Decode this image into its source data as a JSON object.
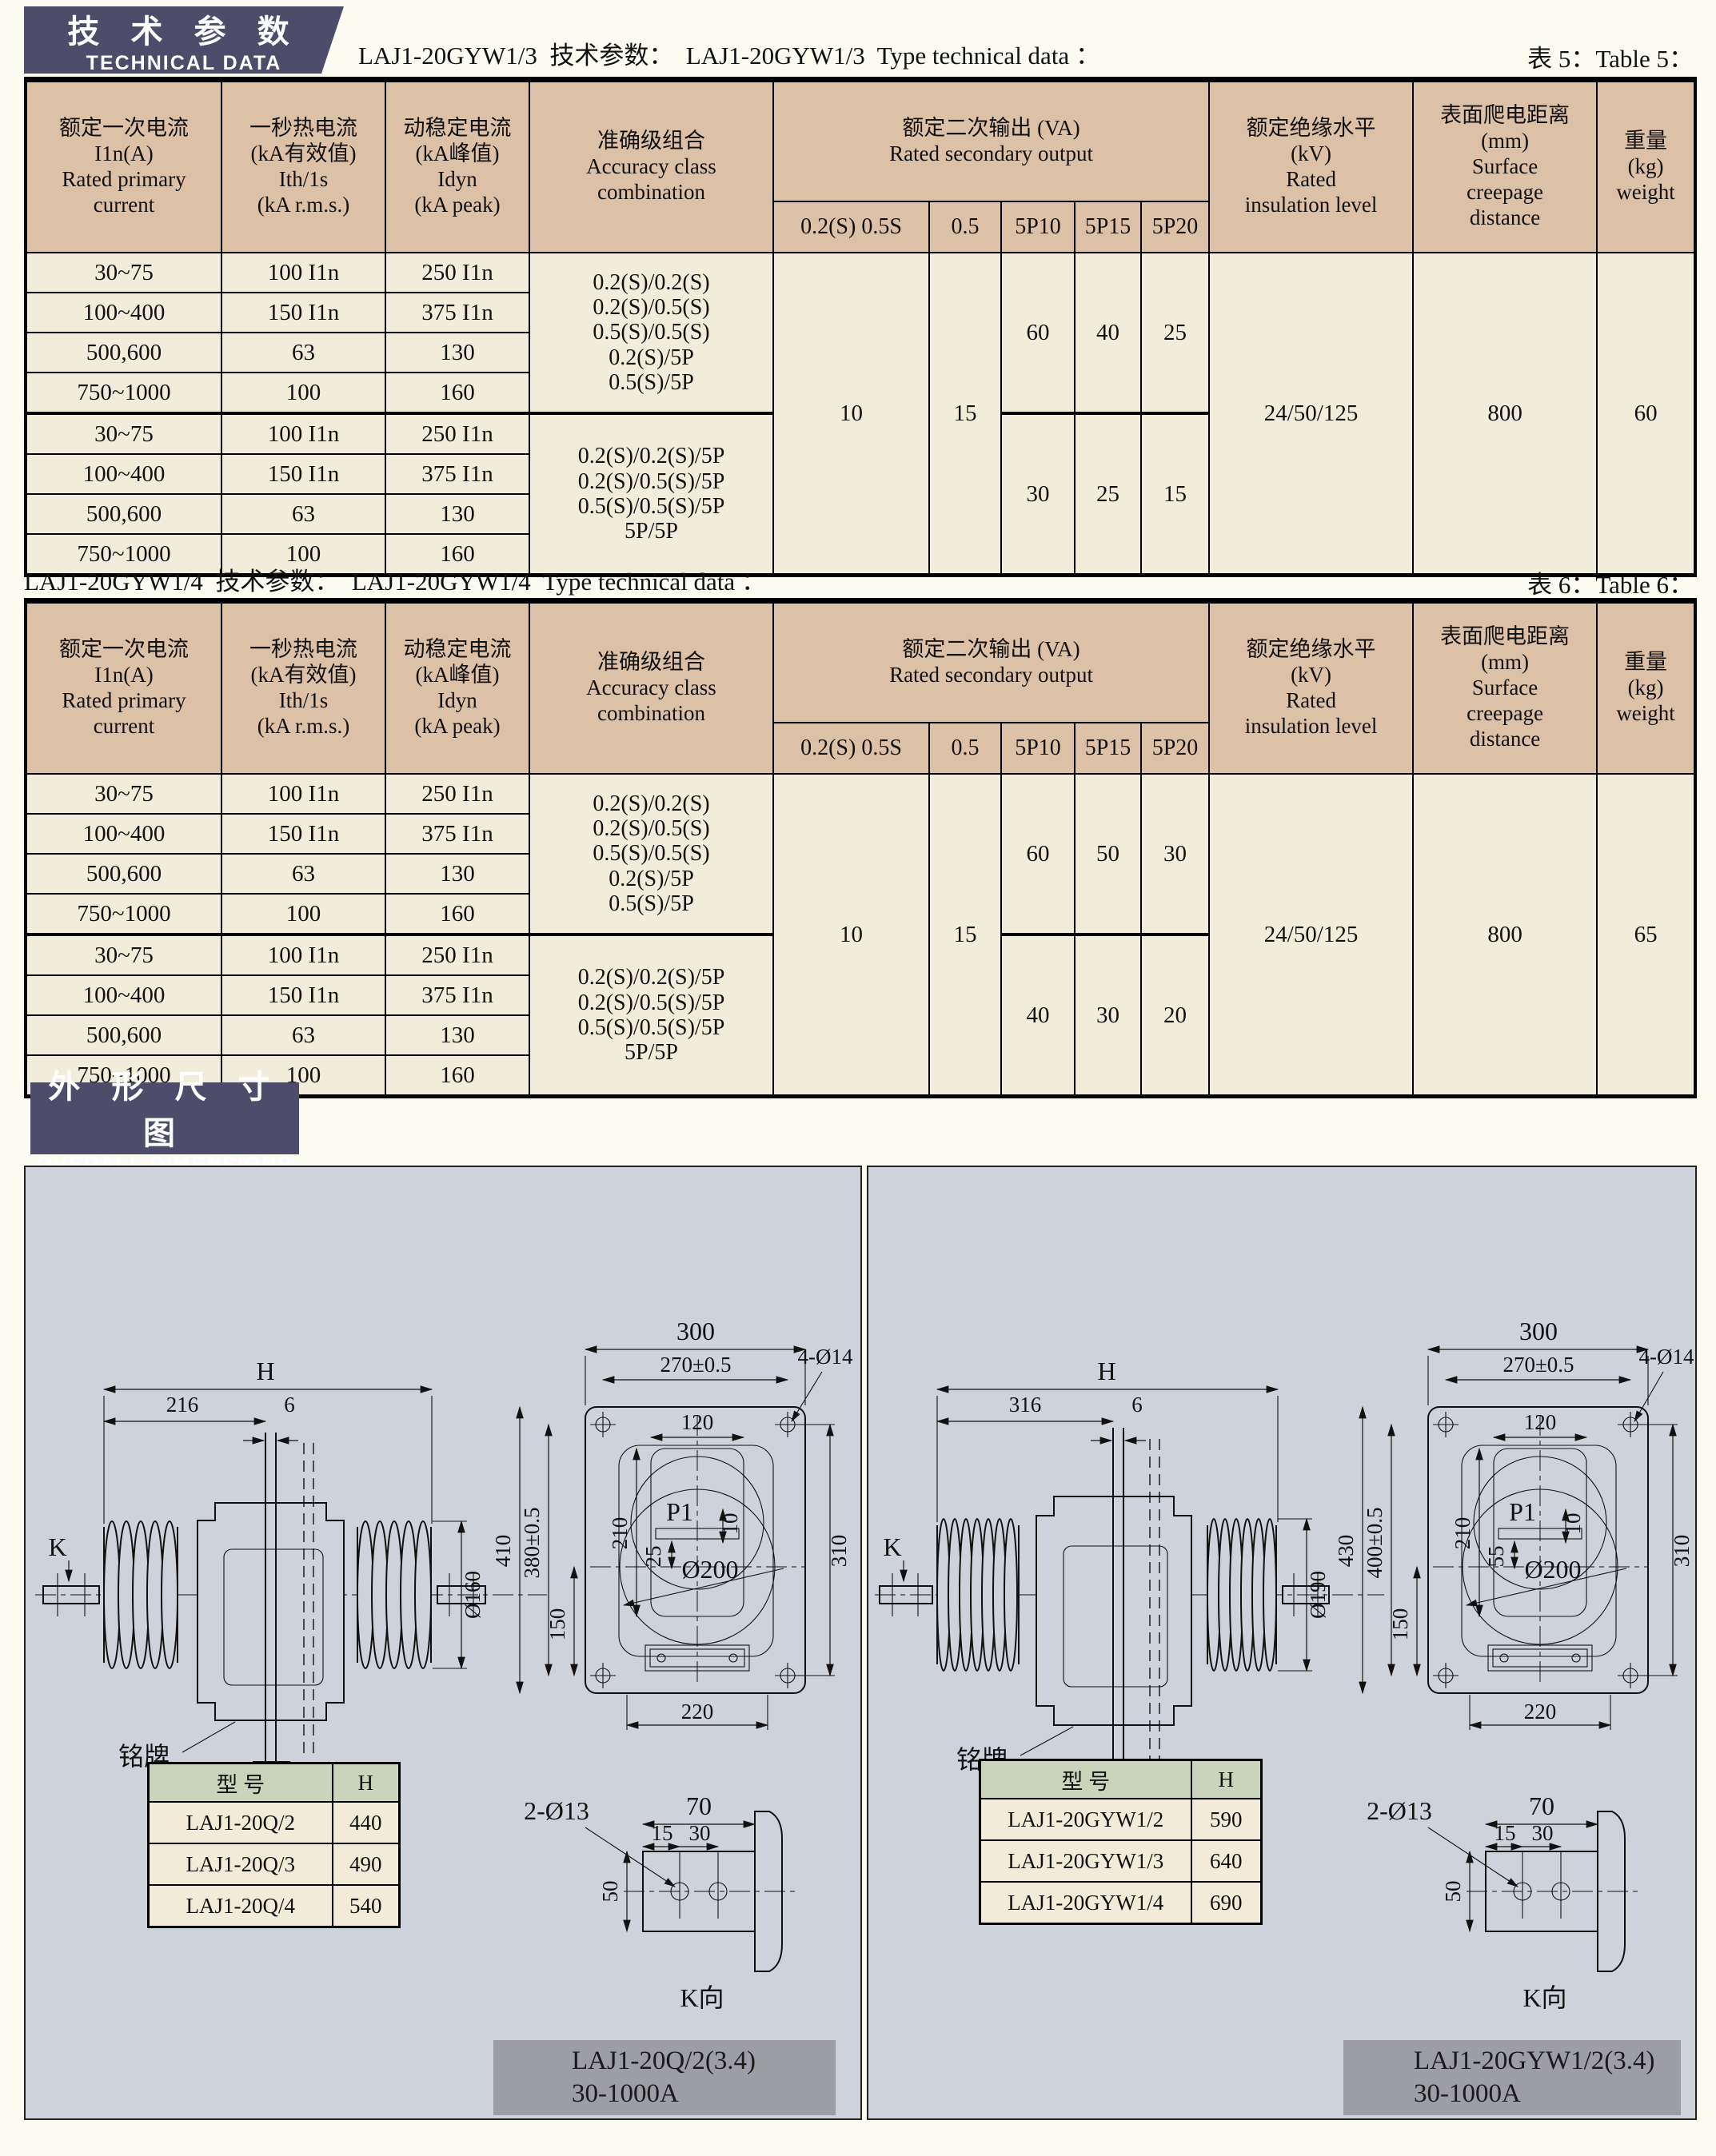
{
  "badges": {
    "tech_zh": "技 术 参 数",
    "tech_en": "TECHNICAL DATA",
    "dim_zh": "外 形 尺 寸 图",
    "dim_en": "OVERALL DIMENSIONS"
  },
  "hdr": {
    "c1": "额定一次电流\nI1n(A)\nRated primary\ncurrent",
    "c2": "一秒热电流\n(kA有效值)\nIth/1s\n(kA r.m.s.)",
    "c3": "动稳定电流\n(kA峰值)\nIdyn\n(kA peak)",
    "c4": "准确级组合\nAccuracy class\ncombination",
    "va": "额定二次输出 (VA)\nRated secondary output",
    "s1": "0.2(S) 0.5S",
    "s2": "0.5",
    "s3": "5P10",
    "s4": "5P15",
    "s5": "5P20",
    "ins": "额定绝缘水平\n(kV)\nRated\ninsulation level",
    "creep": "表面爬电距离\n(mm)\nSurface\ncreepage\ndistance",
    "wt": "重量\n(kg)\nweight"
  },
  "t5": {
    "title": "LAJ1-20GYW1/3  技术参数：  LAJ1-20GYW1/3  Type technical data ：",
    "ref": "表 5：Table 5：",
    "rows": [
      [
        "30~75",
        "100 I1n",
        "250 I1n"
      ],
      [
        "100~400",
        "150 I1n",
        "375 I1n"
      ],
      [
        "500,600",
        "63",
        "130"
      ],
      [
        "750~1000",
        "100",
        "160"
      ],
      [
        "30~75",
        "100 I1n",
        "250 I1n"
      ],
      [
        "100~400",
        "150 I1n",
        "375 I1n"
      ],
      [
        "500,600",
        "63",
        "130"
      ],
      [
        "750~1000",
        "100",
        "160"
      ]
    ],
    "acc1": "0.2(S)/0.2(S)\n0.2(S)/0.5(S)\n0.5(S)/0.5(S)\n0.2(S)/5P\n0.5(S)/5P",
    "acc2": "0.2(S)/0.2(S)/5P\n0.2(S)/0.5(S)/5P\n0.5(S)/0.5(S)/5P\n5P/5P",
    "va02s": "10",
    "va05": "15",
    "g1": [
      "60",
      "40",
      "25"
    ],
    "g2": [
      "30",
      "25",
      "15"
    ],
    "ins": "24/50/125",
    "creep": "800",
    "wt": "60"
  },
  "t6": {
    "title": "LAJ1-20GYW1/4  技术参数：  LAJ1-20GYW1/4  Type technical data ：",
    "ref": "表 6：Table 6：",
    "rows": [
      [
        "30~75",
        "100 I1n",
        "250 I1n"
      ],
      [
        "100~400",
        "150 I1n",
        "375 I1n"
      ],
      [
        "500,600",
        "63",
        "130"
      ],
      [
        "750~1000",
        "100",
        "160"
      ],
      [
        "30~75",
        "100 I1n",
        "250 I1n"
      ],
      [
        "100~400",
        "150 I1n",
        "375 I1n"
      ],
      [
        "500,600",
        "63",
        "130"
      ],
      [
        "750~1000",
        "100",
        "160"
      ]
    ],
    "acc1": "0.2(S)/0.2(S)\n0.2(S)/0.5(S)\n0.5(S)/0.5(S)\n0.2(S)/5P\n0.5(S)/5P",
    "acc2": "0.2(S)/0.2(S)/5P\n0.2(S)/0.5(S)/5P\n0.5(S)/0.5(S)/5P\n5P/5P",
    "va02s": "10",
    "va05": "15",
    "g1": [
      "60",
      "50",
      "30"
    ],
    "g2": [
      "40",
      "30",
      "20"
    ],
    "ins": "24/50/125",
    "creep": "800",
    "wt": "65"
  },
  "left": {
    "dims": {
      "H": "H",
      "w1": "216",
      "gap": "6",
      "k": "K",
      "dia": "Ø160",
      "np": "铭牌",
      "w300": "300",
      "w270": "270±0.5",
      "holes": "4-Ø14",
      "w120": "120",
      "p1": "P1",
      "d10": "10",
      "off": "25",
      "d200": "Ø200",
      "v1": "410",
      "v2": "380±0.5",
      "v210": "210",
      "v150": "150",
      "v310": "310",
      "w220": "220",
      "kv70": "70",
      "kv13": "2-Ø13",
      "kv15": "15",
      "kv30": "30",
      "kv50": "50",
      "kvlab": "K向"
    },
    "model": {
      "h1": "型  号",
      "h2": "H",
      "rows": [
        [
          "LAJ1-20Q/2",
          "440"
        ],
        [
          "LAJ1-20Q/3",
          "490"
        ],
        [
          "LAJ1-20Q/4",
          "540"
        ]
      ]
    },
    "caption": "LAJ1-20Q/2(3.4)\n30-1000A"
  },
  "right": {
    "dims": {
      "H": "H",
      "w1": "316",
      "gap": "6",
      "k": "K",
      "dia": "Ø190",
      "np": "铭牌",
      "w300": "300",
      "w270": "270±0.5",
      "holes": "4-Ø14",
      "w120": "120",
      "p1": "P1",
      "d10": "10",
      "off": "55",
      "d200": "Ø200",
      "v1": "430",
      "v2": "400±0.5",
      "v210": "210",
      "v150": "150",
      "v310": "310",
      "w220": "220",
      "kv70": "70",
      "kv13": "2-Ø13",
      "kv15": "15",
      "kv30": "30",
      "kv50": "50",
      "kvlab": "K向"
    },
    "model": {
      "h1": "型   号",
      "h2": "H",
      "rows": [
        [
          "LAJ1-20GYW1/2",
          "590"
        ],
        [
          "LAJ1-20GYW1/3",
          "640"
        ],
        [
          "LAJ1-20GYW1/4",
          "690"
        ]
      ]
    },
    "caption": "LAJ1-20GYW1/2(3.4)\n30-1000A"
  },
  "colors": {
    "badge": "#4d4d6b",
    "header_tan": "#dcc1a7",
    "cell_cream": "#f2ecda",
    "panel": "#ced2db",
    "caption_gray": "#9d9da5",
    "model_header_green": "#cad4bb"
  }
}
